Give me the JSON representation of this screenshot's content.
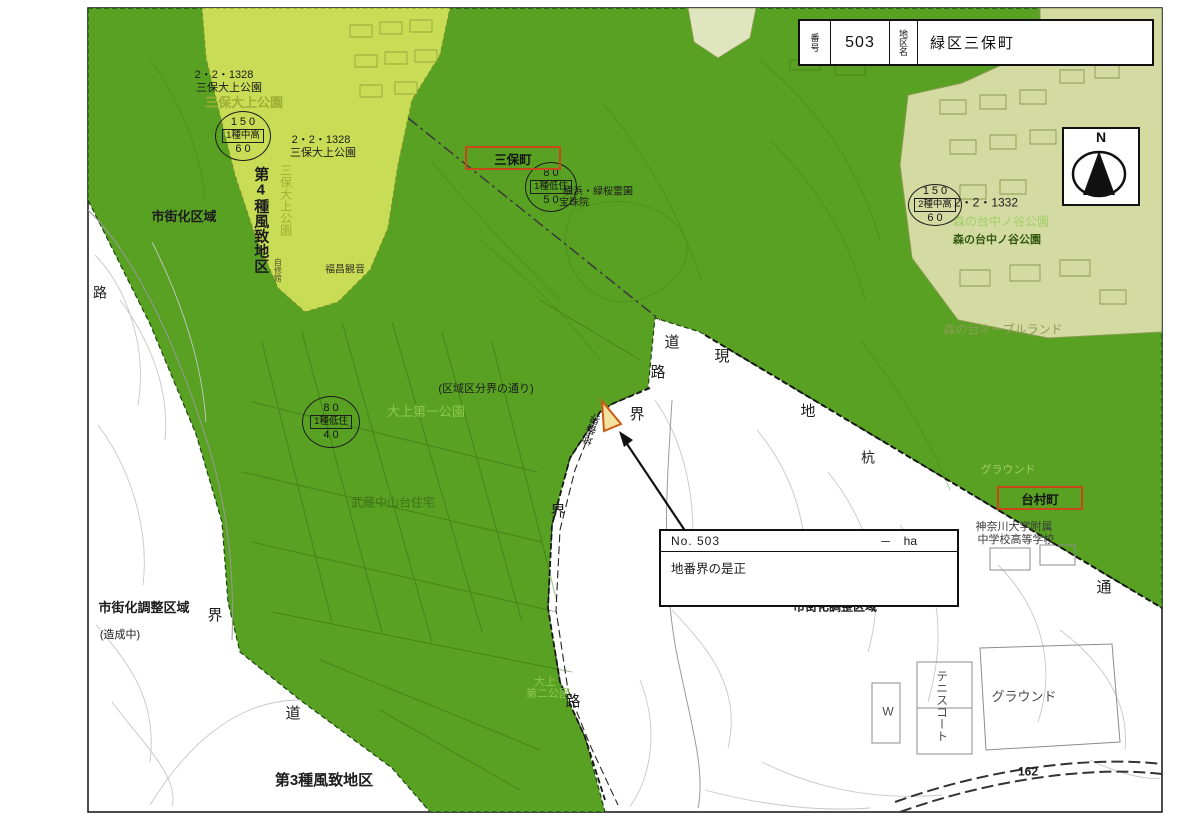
{
  "header": {
    "no_label": "番号",
    "no_value": "503",
    "district_label": "地区名",
    "district_value": "緑区三保町"
  },
  "compass": {
    "label": "N"
  },
  "info_box": {
    "no": "No.  503",
    "area_dash": "－",
    "area_unit": "ha",
    "note": "地番界の是正"
  },
  "red_boxes": {
    "miho": "三保町",
    "daimura": "台村町"
  },
  "zoning_circles": [
    {
      "top": "150",
      "mid": "1種中高",
      "bottom": "60"
    },
    {
      "top": "80",
      "mid": "1種低住",
      "bottom": "50"
    },
    {
      "top": "80",
      "mid": "1種低住",
      "bottom": "40"
    },
    {
      "top": "150",
      "mid": "2種中高",
      "bottom": "60"
    }
  ],
  "colors": {
    "green_main": "#55a01f",
    "yellow_green": "#c9dc55",
    "pale_green": "#d3dba2",
    "red_box_border": "#c8481c",
    "marker_orange": "#cc5a14"
  },
  "map_labels": [
    {
      "t": "2・2・1328",
      "x": 224,
      "y": 75,
      "s": 11
    },
    {
      "t": "三保大上公園",
      "x": 229,
      "y": 88,
      "s": 11
    },
    {
      "t": "三保大上公園",
      "x": 244,
      "y": 103,
      "s": 13,
      "c": "#9fae34",
      "b": 1
    },
    {
      "t": "三保大上公園",
      "x": 285,
      "y": 200,
      "s": 12,
      "c": "#9fae34",
      "v": 1
    },
    {
      "t": "2・2・1328",
      "x": 321,
      "y": 140,
      "s": 11
    },
    {
      "t": "三保大上公園",
      "x": 323,
      "y": 153,
      "s": 11
    },
    {
      "t": "市街化区域",
      "x": 184,
      "y": 217,
      "s": 13,
      "b": 1
    },
    {
      "t": "第4種風致地区",
      "x": 260,
      "y": 220,
      "s": 15,
      "b": 1,
      "v": 1
    },
    {
      "t": "自修館",
      "x": 277,
      "y": 270,
      "s": 8,
      "v": 1,
      "o": 0.7
    },
    {
      "t": "福昌観音",
      "x": 345,
      "y": 270,
      "s": 10,
      "o": 0.85
    },
    {
      "t": "横浜・緑桜霊園",
      "x": 598,
      "y": 192,
      "s": 10
    },
    {
      "t": "宝珠院",
      "x": 574,
      "y": 203,
      "s": 10
    },
    {
      "t": "(区域区分界の通り)",
      "x": 486,
      "y": 389,
      "s": 11
    },
    {
      "t": "大上第一公園",
      "x": 426,
      "y": 412,
      "s": 13,
      "c": "#8cc84b"
    },
    {
      "t": "武蔵中山台住宅",
      "x": 393,
      "y": 503,
      "s": 12,
      "c": "#3f7316"
    },
    {
      "t": "大上",
      "x": 545,
      "y": 682,
      "s": 11,
      "c": "#8cc84b"
    },
    {
      "t": "第二公園",
      "x": 548,
      "y": 694,
      "s": 11,
      "c": "#8cc84b"
    },
    {
      "t": "道",
      "x": 672,
      "y": 343,
      "s": 15
    },
    {
      "t": "路",
      "x": 658,
      "y": 373,
      "s": 15
    },
    {
      "t": "現",
      "x": 722,
      "y": 357,
      "s": 15
    },
    {
      "t": "地",
      "x": 808,
      "y": 412,
      "s": 15
    },
    {
      "t": "界",
      "x": 637,
      "y": 415,
      "s": 15
    },
    {
      "t": "界",
      "x": 558,
      "y": 512,
      "s": 15
    },
    {
      "t": "杭",
      "x": 868,
      "y": 458,
      "s": 14
    },
    {
      "t": "界",
      "x": 215,
      "y": 616,
      "s": 15
    },
    {
      "t": "道",
      "x": 293,
      "y": 714,
      "s": 15
    },
    {
      "t": "路",
      "x": 573,
      "y": 702,
      "s": 15
    },
    {
      "t": "路",
      "x": 100,
      "y": 293,
      "s": 14
    },
    {
      "t": "通",
      "x": 1104,
      "y": 588,
      "s": 15
    },
    {
      "t": "市街化調整区域",
      "x": 144,
      "y": 608,
      "s": 13,
      "b": 1
    },
    {
      "t": "(造成中)",
      "x": 120,
      "y": 635,
      "s": 11
    },
    {
      "t": "第3種風致地区",
      "x": 324,
      "y": 781,
      "s": 15,
      "b": 1
    },
    {
      "t": "市街化調整区域",
      "x": 835,
      "y": 607,
      "s": 12,
      "b": 1
    },
    {
      "t": "2・2・1332",
      "x": 986,
      "y": 203,
      "s": 12
    },
    {
      "t": "森の台中ノ谷公園",
      "x": 1001,
      "y": 222,
      "s": 12,
      "c": "#a3cd67"
    },
    {
      "t": "森の台中ノ谷公園",
      "x": 997,
      "y": 240,
      "s": 11,
      "c": "#33590f",
      "b": 1
    },
    {
      "t": "森の台ネーブルランド",
      "x": 1003,
      "y": 330,
      "s": 12,
      "c": "#8e9c54"
    },
    {
      "t": "グラウンド",
      "x": 1008,
      "y": 470,
      "s": 11,
      "c": "#a3cd67"
    },
    {
      "t": "神奈川大学附属",
      "x": 1014,
      "y": 527,
      "s": 11,
      "c": "#3a3a3a"
    },
    {
      "t": "中学校高等学校",
      "x": 1016,
      "y": 540,
      "s": 11,
      "c": "#3a3a3a"
    },
    {
      "t": "グラウンド",
      "x": 1024,
      "y": 697,
      "s": 13,
      "c": "#4a4a4a"
    },
    {
      "t": "テニスコート",
      "x": 941,
      "y": 706,
      "s": 12,
      "c": "#4a4a4a",
      "v": 1
    },
    {
      "t": "W",
      "x": 888,
      "y": 712,
      "s": 12,
      "c": "#4a4a4a"
    },
    {
      "t": "162",
      "x": 1028,
      "y": 772,
      "s": 12,
      "b": 1
    },
    {
      "t": "地番界",
      "x": 592,
      "y": 430,
      "s": 11,
      "v": 1,
      "r": 200
    }
  ]
}
